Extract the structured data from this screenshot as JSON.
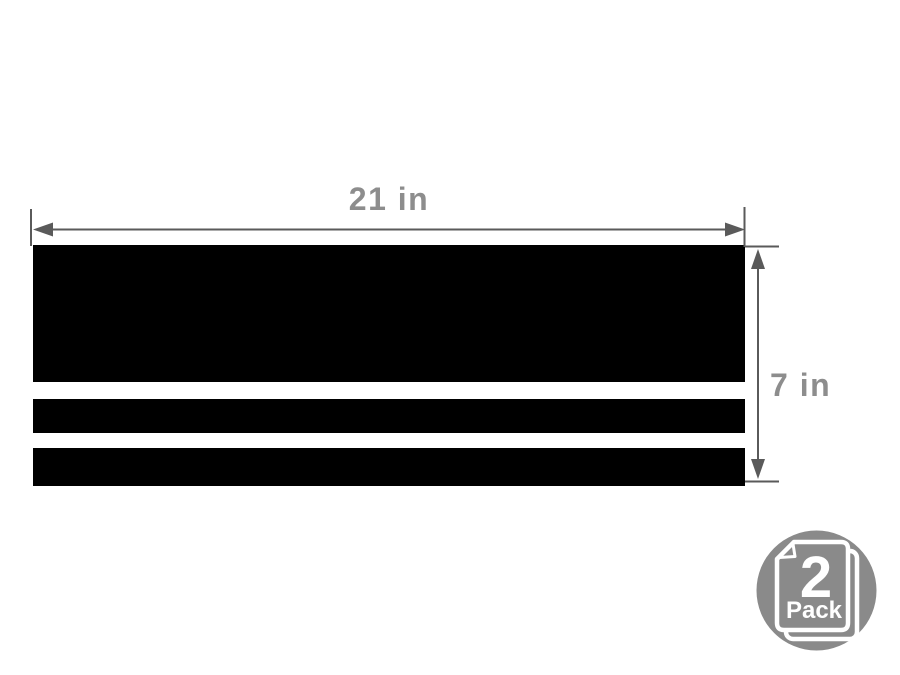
{
  "diagram": {
    "description": "triple-stripe decal dimension diagram",
    "width_label": "21 in",
    "height_label": "7 in",
    "stripe_count": 3
  },
  "badge": {
    "count": "2",
    "label": "Pack",
    "icon": "stacked-sheets-icon"
  },
  "colors": {
    "background": "#ffffff",
    "stripe": "#000000",
    "dimension_line": "#5a5a5a",
    "dimension_label": "#8d8d8d",
    "badge_circle": "#8a8a8a",
    "badge_text": "#ffffff"
  }
}
